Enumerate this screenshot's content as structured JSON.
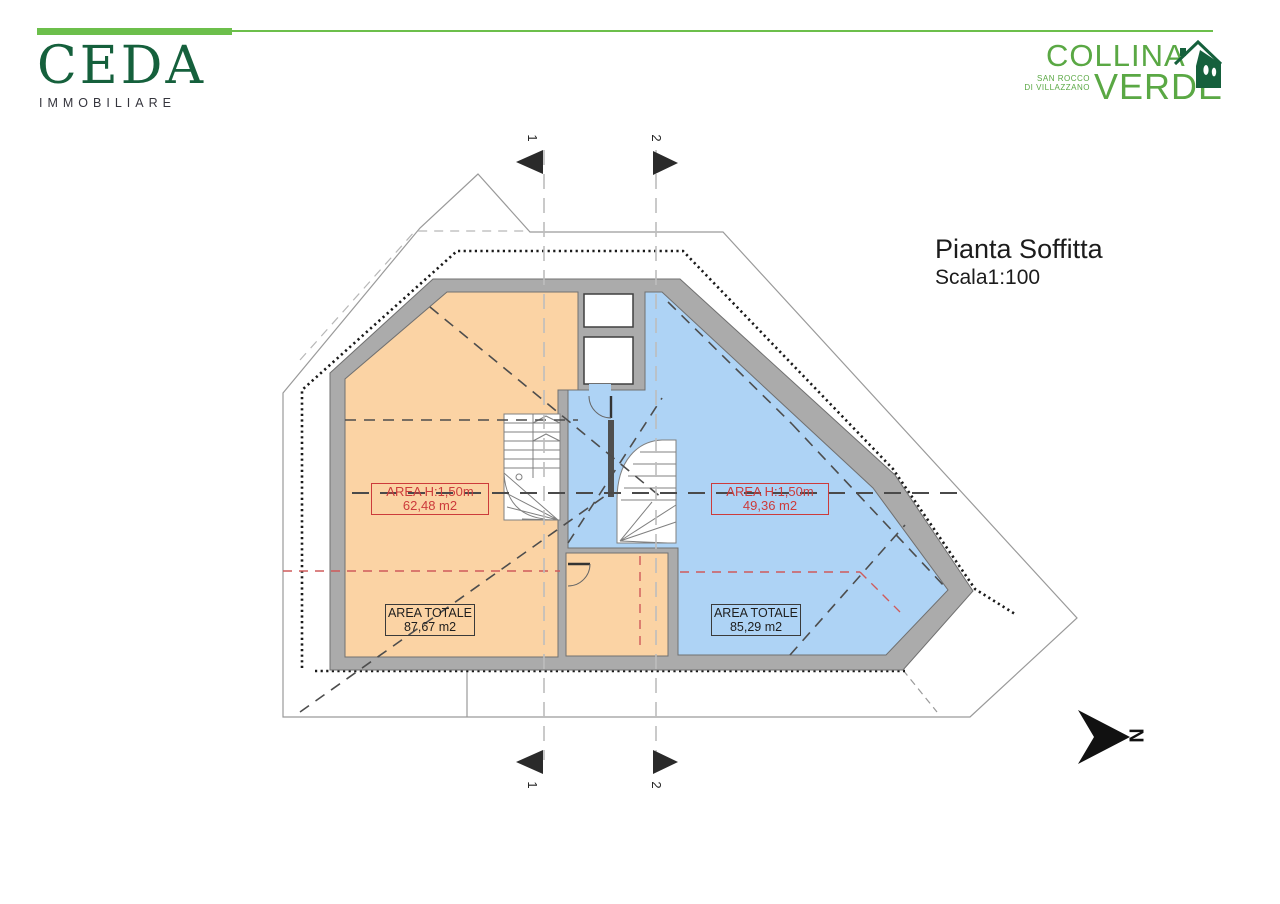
{
  "header": {
    "eda": {
      "name": "CEDA",
      "subtitle": "IMMOBILIARE"
    },
    "collina": {
      "line1": "COLLINA",
      "line2": "VERDE",
      "sub1": "SAN ROCCO",
      "sub2": "DI VILLAZZANO"
    },
    "accent_green": "#6cbf4b",
    "eda_green": "#15603c",
    "collina_green": "#5aa844"
  },
  "title": {
    "main": "Pianta Soffitta",
    "scale": "Scala1:100"
  },
  "plan": {
    "labels": {
      "left_h": {
        "line1": "AREA H:1,50m",
        "line2": "62,48 m2"
      },
      "right_h": {
        "line1": "AREA H:1,50m",
        "line2": "49,36 m2"
      },
      "left_tot": {
        "line1": "AREA TOTALE",
        "line2": "87,67 m2"
      },
      "right_tot": {
        "line1": "AREA TOTALE",
        "line2": "85,29 m2"
      }
    },
    "sections": {
      "s1": "1",
      "s2": "2"
    },
    "north_letter": "N",
    "colors": {
      "room_orange": "#fbd3a4",
      "room_blue": "#aed3f5",
      "wall_gray": "#ababab",
      "label_red": "#cc3b3b"
    }
  }
}
